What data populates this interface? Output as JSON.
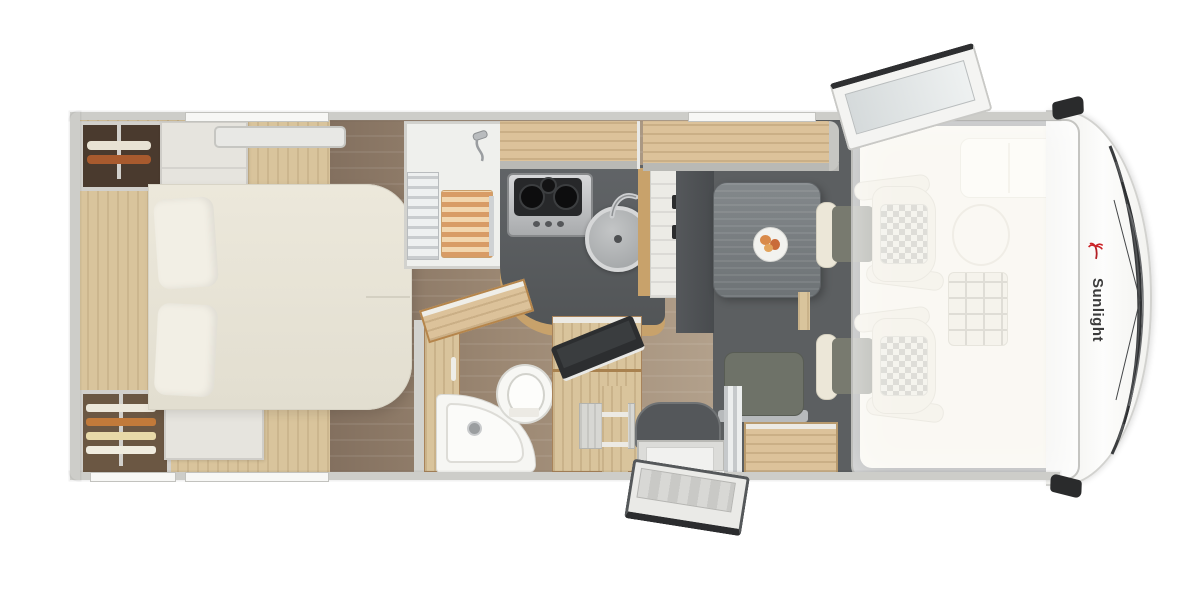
{
  "brand": {
    "name": "Sunlight",
    "logo": "palm-icon"
  },
  "colors": {
    "wall": "#cdcdc9",
    "wood_light": "#d9c49c",
    "wood_locker": "#dcc29a",
    "wood_mid": "#c8a26b",
    "floor_dark": "#83705f",
    "floor_light": "#b3a18c",
    "charcoal_floor": "#5c5f61",
    "cab_floor": "#6b6e70",
    "counter_dark": "#5a5d5f",
    "table_gray": "#7a7f82",
    "bed_cream": "#ece8db",
    "seat_cream": "#ece7d8",
    "seat_cushion": "#787a6f",
    "clothes_rust": "#a85a2e",
    "steel": "#a9abad",
    "dark_trim": "#2e3032",
    "brand_red": "#cc2328",
    "brand_text": "#3b3b3b"
  },
  "icons": {
    "palm-icon": "red palm tree brand logo",
    "shower-head-icon": "chrome shower head with hose",
    "faucet-icon": "chrome swivel faucet",
    "wiper-icon": "windshield wiper arcs"
  }
}
